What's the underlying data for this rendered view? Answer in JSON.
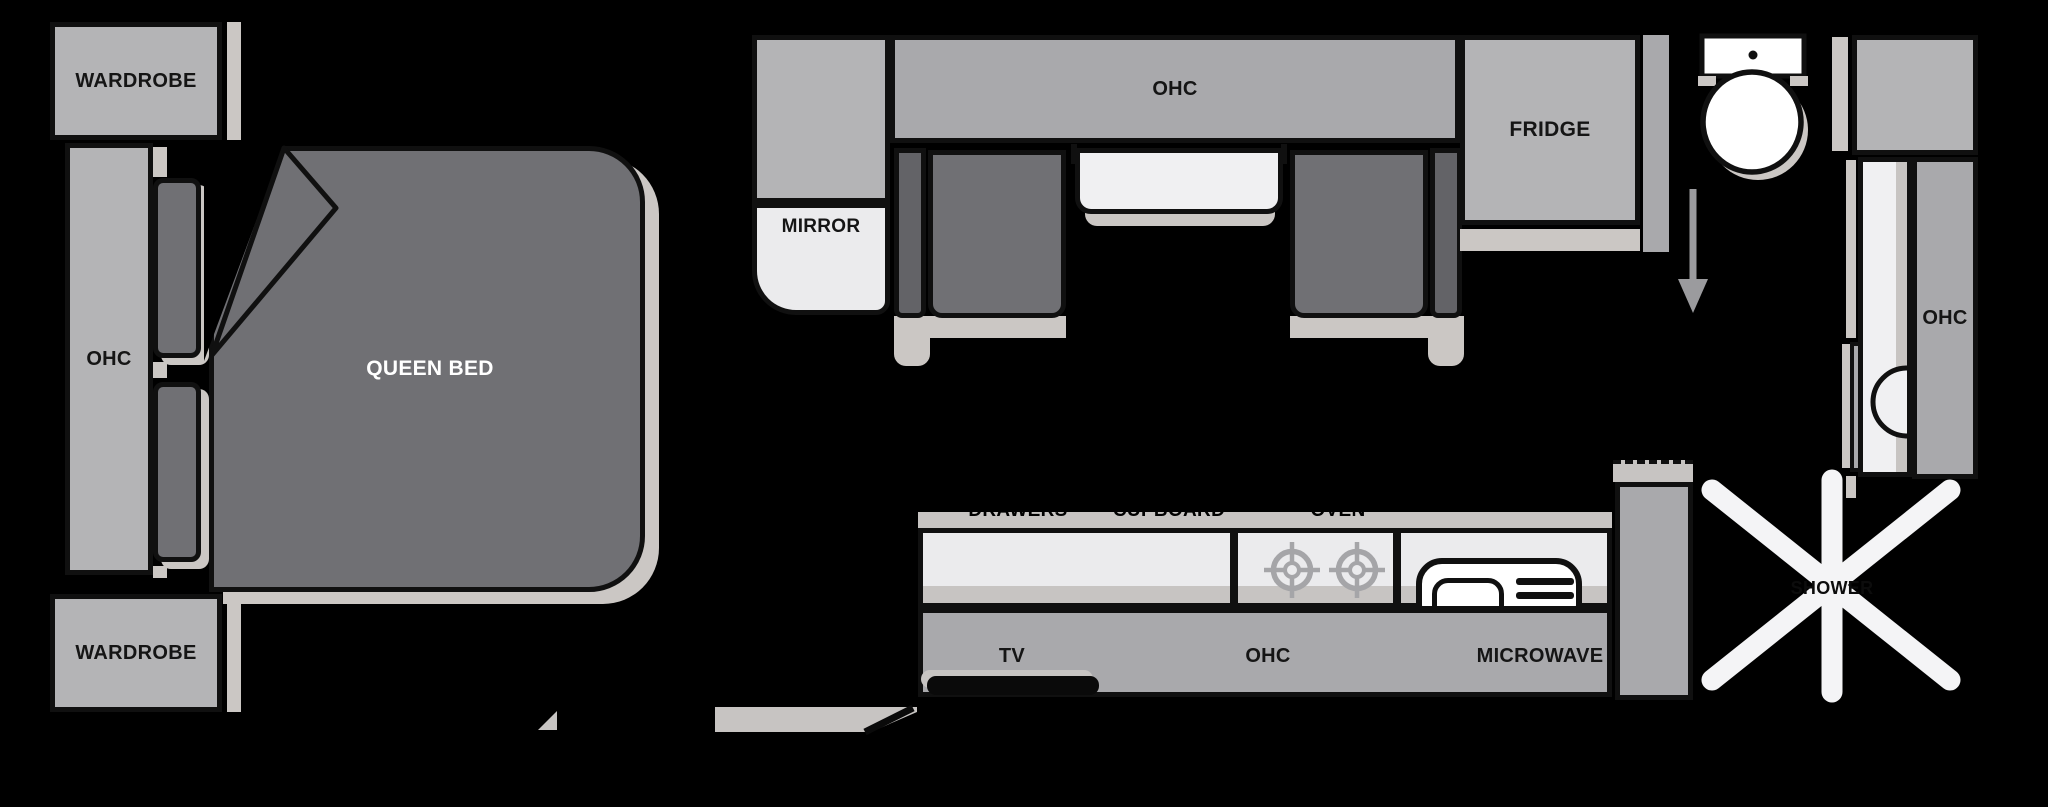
{
  "title": "RV travel trailer floorplan",
  "colors": {
    "outline": "#101010",
    "cabinet_light": "#b4b4b6",
    "cabinet_mid": "#a9a9ac",
    "furniture_dark": "#707074",
    "furniture_dark2": "#636367",
    "shadow": "#cbc7c4",
    "surface_light": "#ebebed",
    "counter_edge": "#c7c4c2",
    "white": "#ffffff",
    "text": "#151515",
    "shower_white": "#f4f4f6",
    "burner": "#a5a5a8",
    "arrow": "#9b9b9e"
  },
  "bedroom": {
    "wardrobe_top": "WARDROBE",
    "ohc": "OHC",
    "bed": "QUEEN BED",
    "wardrobe_bottom": "WARDROBE"
  },
  "dinette": {
    "mirror": "MIRROR",
    "ohc": "OHC"
  },
  "kitchen": {
    "fridge": "FRIDGE",
    "drawers": "DRAWERS",
    "cupboard": "CUPBOARD",
    "oven": "OVEN",
    "tv": "TV",
    "ohc": "OHC",
    "microwave": "MICROWAVE"
  },
  "bathroom": {
    "ohc": "OHC",
    "shower": "SHOWER"
  }
}
